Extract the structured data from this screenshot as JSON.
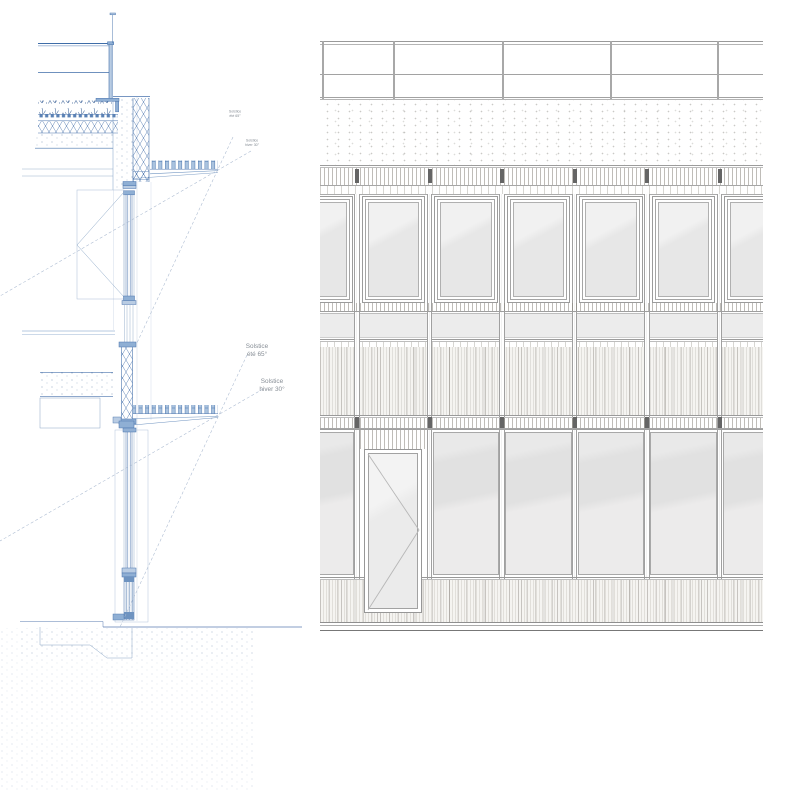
{
  "drawing": {
    "kind": "architectural facade detail",
    "left_panel": "wall section with green roof, brise-soleil louvers and sun angle rays",
    "right_panel": "facade elevation with roof railing, window bays, slat spandrels and entrance door"
  },
  "annotations": {
    "roof_summer": {
      "line1": "Solstice",
      "line2": "été 65°"
    },
    "roof_winter": {
      "line1": "Solstice",
      "line2": "hiver 30°"
    },
    "floor_summer": {
      "line1": "Solstice",
      "line2": "été 65°"
    },
    "floor_winter": {
      "line1": "Solstice",
      "line2": "hiver 30°"
    }
  },
  "colors": {
    "section_blue": "#4a74ad",
    "section_blue_light": "#aac3df",
    "section_blue_mid": "#8fafd4",
    "sun_ray_dash": "#a8b8cf",
    "facade_line": "#a0a0a0",
    "facade_dark_post": "#656565",
    "glass": "#e7e7e7",
    "spandrel_panel": "#ececec",
    "annotation_text": "#878e96"
  },
  "facade": {
    "mullions_ext_x": [
      -35.5,
      37,
      109.5,
      182,
      254.5,
      327,
      399.5,
      472
    ],
    "visible_mullions": [
      37,
      109.5,
      182,
      254.5,
      327,
      399.5
    ],
    "railing_posts_x": [
      2,
      73,
      182,
      290,
      397
    ],
    "door_bay": 1,
    "width": 443,
    "height": 592
  }
}
